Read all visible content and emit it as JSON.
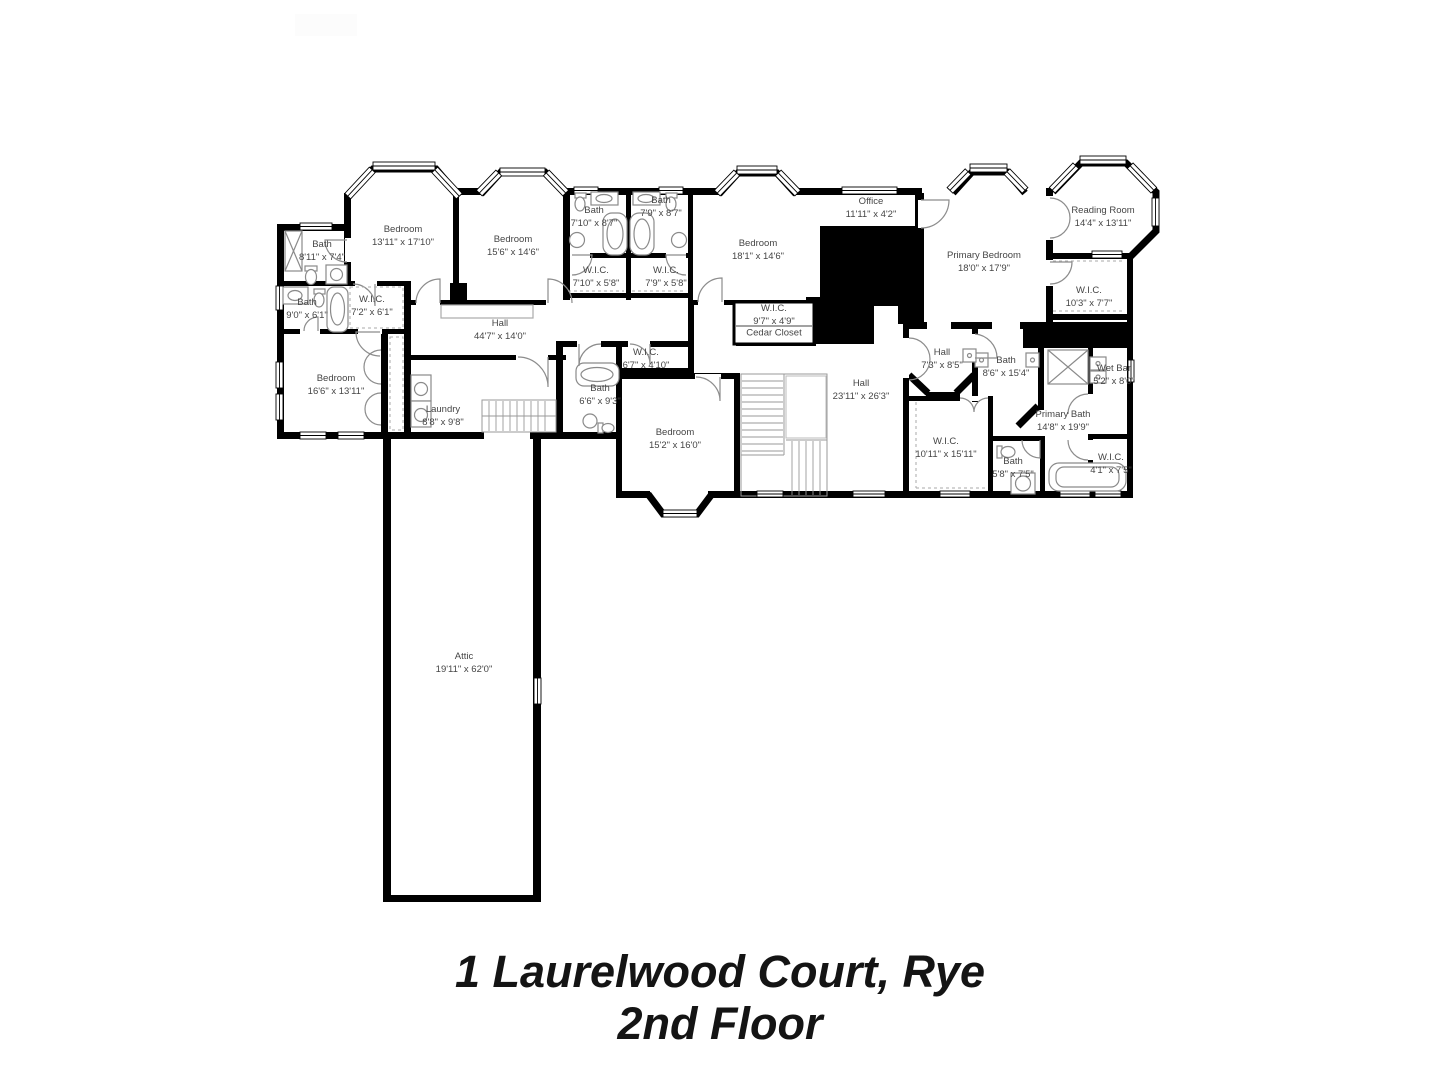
{
  "title": {
    "line1": "1 Laurelwood Court, Rye",
    "line2": "2nd Floor"
  },
  "rooms": [
    {
      "label": "Bath",
      "dims": "8'11\" x 7'4\"",
      "x": 322,
      "y": 251
    },
    {
      "label": "Bedroom",
      "dims": "13'11\" x 17'10\"",
      "x": 403,
      "y": 236
    },
    {
      "label": "Bedroom",
      "dims": "15'6\" x 14'6\"",
      "x": 513,
      "y": 246
    },
    {
      "label": "Bath",
      "dims": "7'10\" x 8'7\"",
      "x": 594,
      "y": 217
    },
    {
      "label": "Bath",
      "dims": "7'9\" x 8'7\"",
      "x": 661,
      "y": 207
    },
    {
      "label": "Bedroom",
      "dims": "18'1\" x 14'6\"",
      "x": 758,
      "y": 250
    },
    {
      "label": "Office",
      "dims": "11'11\" x 4'2\"",
      "x": 871,
      "y": 208
    },
    {
      "label": "Primary Bedroom",
      "dims": "18'0\" x 17'9\"",
      "x": 984,
      "y": 262
    },
    {
      "label": "Reading Room",
      "dims": "14'4\" x 13'11\"",
      "x": 1103,
      "y": 217
    },
    {
      "label": "Bath",
      "dims": "9'0\" x 6'1\"",
      "x": 307,
      "y": 309
    },
    {
      "label": "W.I.C.",
      "dims": "7'2\" x 6'1\"",
      "x": 372,
      "y": 306
    },
    {
      "label": "W.I.C.",
      "dims": "7'10\" x 5'8\"",
      "x": 596,
      "y": 277
    },
    {
      "label": "W.I.C.",
      "dims": "7'9\" x 5'8\"",
      "x": 666,
      "y": 277
    },
    {
      "label": "W.I.C.",
      "dims": "9'7\" x 4'9\"",
      "x": 774,
      "y": 315
    },
    {
      "label": "Cedar Closet",
      "dims": "",
      "x": 774,
      "y": 333
    },
    {
      "label": "Hall",
      "dims": "44'7\" x 14'0\"",
      "x": 500,
      "y": 330
    },
    {
      "label": "W.I.C.",
      "dims": "10'3\" x 7'7\"",
      "x": 1089,
      "y": 297
    },
    {
      "label": "Bedroom",
      "dims": "16'6\" x 13'11\"",
      "x": 336,
      "y": 385
    },
    {
      "label": "Laundry",
      "dims": "8'8\" x 9'8\"",
      "x": 443,
      "y": 416
    },
    {
      "label": "W.I.C.",
      "dims": "6'7\" x 4'10\"",
      "x": 646,
      "y": 359
    },
    {
      "label": "Bath",
      "dims": "6'6\" x 9'3\"",
      "x": 600,
      "y": 395
    },
    {
      "label": "Bedroom",
      "dims": "15'2\" x 16'0\"",
      "x": 675,
      "y": 439
    },
    {
      "label": "Hall",
      "dims": "23'11\" x 26'3\"",
      "x": 861,
      "y": 390
    },
    {
      "label": "Hall",
      "dims": "7'3\" x 8'5\"",
      "x": 942,
      "y": 359
    },
    {
      "label": "Bath",
      "dims": "8'6\" x 15'4\"",
      "x": 1006,
      "y": 367
    },
    {
      "label": "Wet Bar",
      "dims": "5'2\" x 8'0\"",
      "x": 1114,
      "y": 375
    },
    {
      "label": "Primary Bath",
      "dims": "14'8\" x 19'9\"",
      "x": 1063,
      "y": 421
    },
    {
      "label": "W.I.C.",
      "dims": "10'11\" x 15'11\"",
      "x": 946,
      "y": 448
    },
    {
      "label": "Bath",
      "dims": "5'8\" x 7'5\"",
      "x": 1013,
      "y": 468
    },
    {
      "label": "W.I.C.",
      "dims": "4'1\" x 7'5\"",
      "x": 1111,
      "y": 464
    },
    {
      "label": "Attic",
      "dims": "19'11\" x 62'0\"",
      "x": 464,
      "y": 663
    }
  ],
  "colors": {
    "wall": "#000000",
    "fixture": "#8a8a8a",
    "label": "#454545",
    "title": "#141414"
  }
}
